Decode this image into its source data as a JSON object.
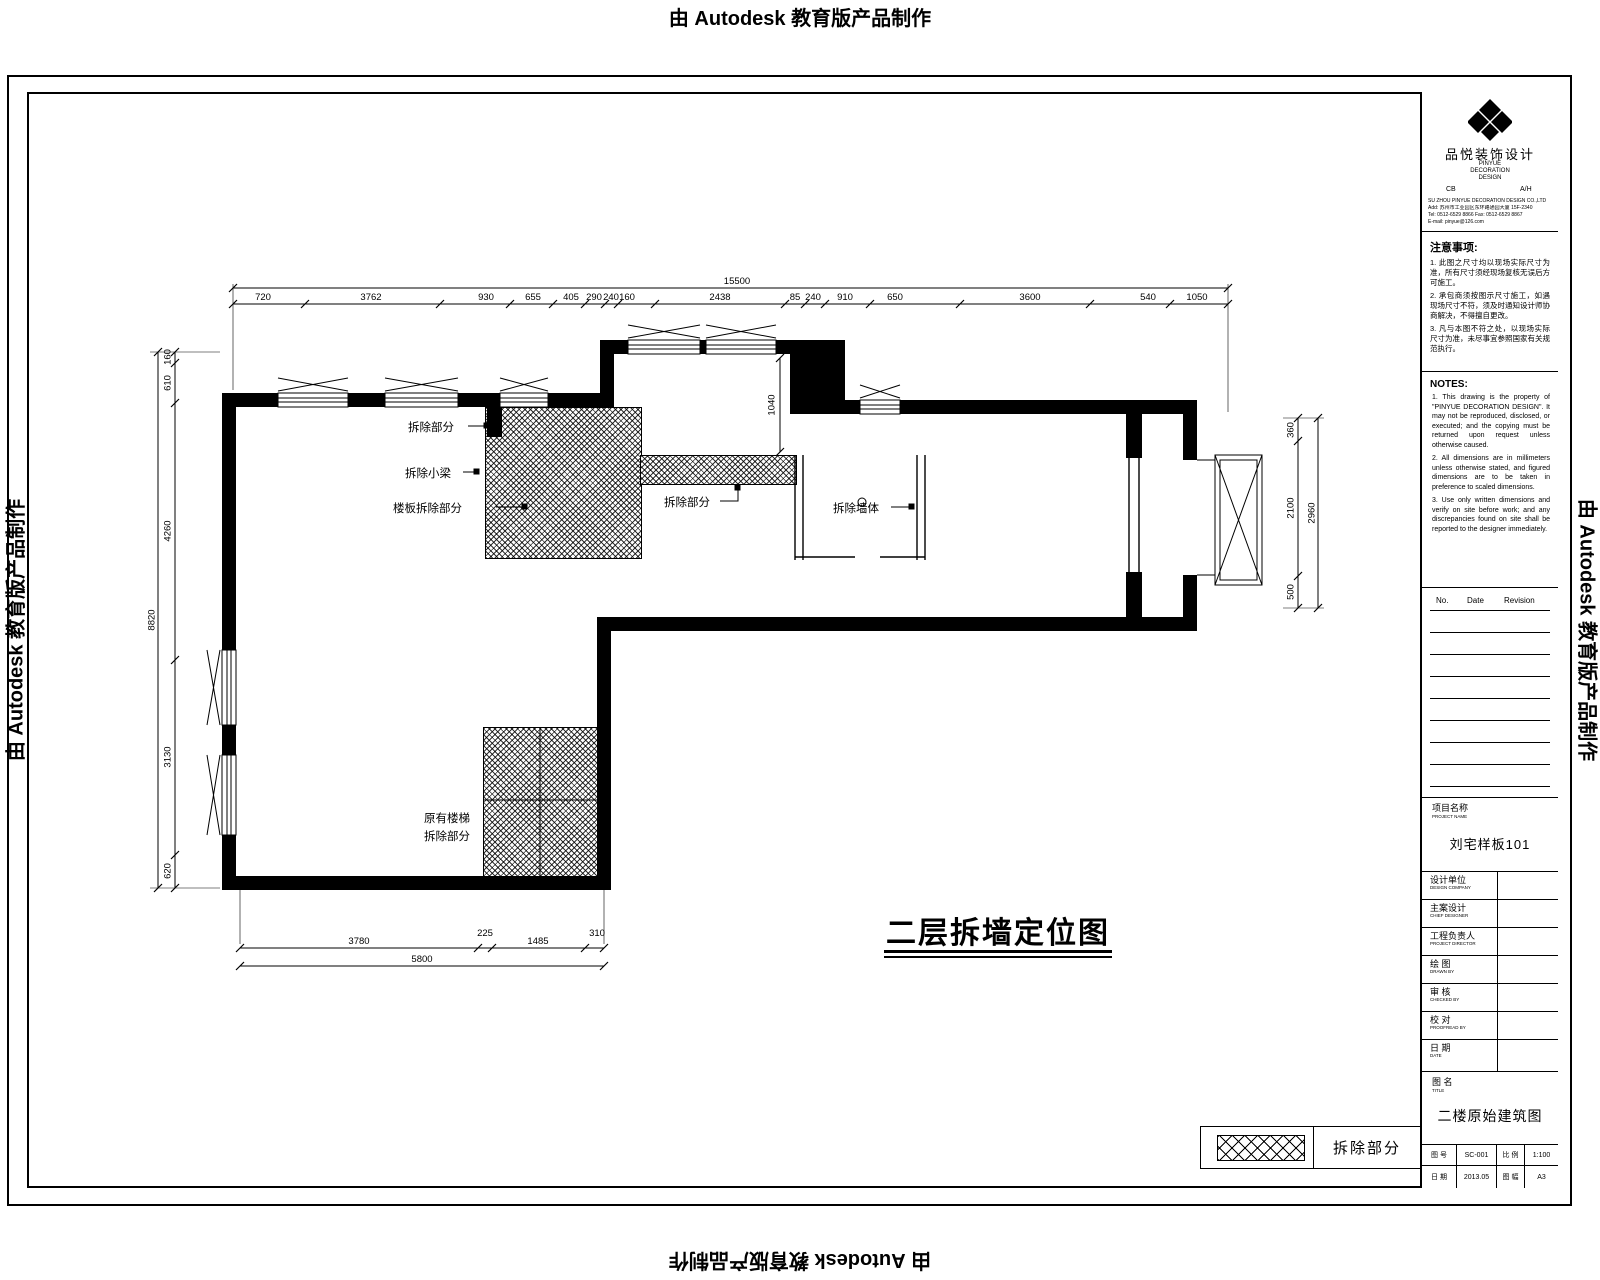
{
  "watermark": {
    "text": "由 Autodesk 教育版产品制作"
  },
  "plan": {
    "title": "二层拆墙定位图",
    "labels": {
      "l1": "拆除部分",
      "l2": "拆除小梁",
      "l3": "楼板拆除部分",
      "l4": "拆除部分",
      "l5": "拆除墙体",
      "l6a": "原有楼梯",
      "l6b": "拆除部分"
    },
    "legend_label": "拆除部分"
  },
  "dims": {
    "top": [
      "720",
      "3762",
      "930",
      "655",
      "405",
      "290",
      "240",
      "160",
      "2438",
      "85",
      "240",
      "910",
      "650",
      "3600",
      "540",
      "1050"
    ],
    "top_overall": "15500",
    "left": [
      "160",
      "610",
      "4260",
      "3130",
      "620"
    ],
    "left_overall": "8820",
    "right": [
      "360",
      "2100",
      "500"
    ],
    "right_overall": "2960",
    "bottom": [
      "3780",
      "225",
      "1485",
      "310"
    ],
    "bottom_overall": "5800",
    "room": [
      "1040"
    ]
  },
  "titleblock": {
    "logo": {
      "name_cn": "品悦装饰设计",
      "name_en1": "PINYUE",
      "name_en2": "DECORATION",
      "name_en3": "DESIGN",
      "sub_left": "CB",
      "sub_right": "A/H",
      "address": [
        "SU ZHOU PINYUE DECORATION DESIGN CO.,LTD",
        "Add: 苏州市工业园区东环路通园大厦 15F-2340",
        "Tel: 0512-6529 8866  Fax: 0512-6529 8867",
        "E-mail: pinyue@126.com"
      ]
    },
    "notes_cn": {
      "heading": "注意事项:",
      "items": [
        "1. 此图之尺寸均以现场实际尺寸为准，所有尺寸须经现场复核无误后方可施工。",
        "2. 承包商须按图示尺寸施工，如遇现场尺寸不符，须及时通知设计师协商解决，不得擅自更改。",
        "3. 凡与本图不符之处，以现场实际尺寸为准，未尽事宜参照国家有关规范执行。"
      ]
    },
    "notes_en": {
      "heading": "NOTES:",
      "items": [
        "1. This drawing is the property of \"PINYUE DECORATION DESIGN\". It may not be reproduced, disclosed, or executed; and the copying must be returned upon request unless otherwise caused.",
        "2. All dimensions are in millimeters unless otherwise stated, and figured dimensions are to be taken in preference to scaled dimensions.",
        "3. Use only written dimensions and verify on site before work; and any discrepancies found on site shall be reported to the designer immediately."
      ]
    },
    "revision": {
      "headers": [
        "No.",
        "Date",
        "Revision"
      ]
    },
    "project": {
      "label_cn": "项目名称",
      "label_en": "PROJECT NAME",
      "value": "刘宅样板101"
    },
    "fields": [
      {
        "cn": "设计单位",
        "en": "DESIGN COMPANY"
      },
      {
        "cn": "主案设计",
        "en": "CHIEF DESIGNER"
      },
      {
        "cn": "工程负责人",
        "en": "PROJECT DIRECTOR"
      },
      {
        "cn": "绘  图",
        "en": "DRAWN BY"
      },
      {
        "cn": "审  核",
        "en": "CHECKED BY"
      },
      {
        "cn": "校  对",
        "en": "PROOFREAD BY"
      },
      {
        "cn": "日  期",
        "en": "DATE"
      }
    ],
    "dtitle": {
      "label_cn": "图  名",
      "label_en": "TITLE",
      "value": "二楼原始建筑图"
    },
    "minitable": {
      "rows": [
        [
          "图 号",
          "SC-001",
          "比 例",
          "1:100"
        ],
        [
          "日 期",
          "2013.05",
          "图 幅",
          "A3"
        ]
      ]
    }
  }
}
